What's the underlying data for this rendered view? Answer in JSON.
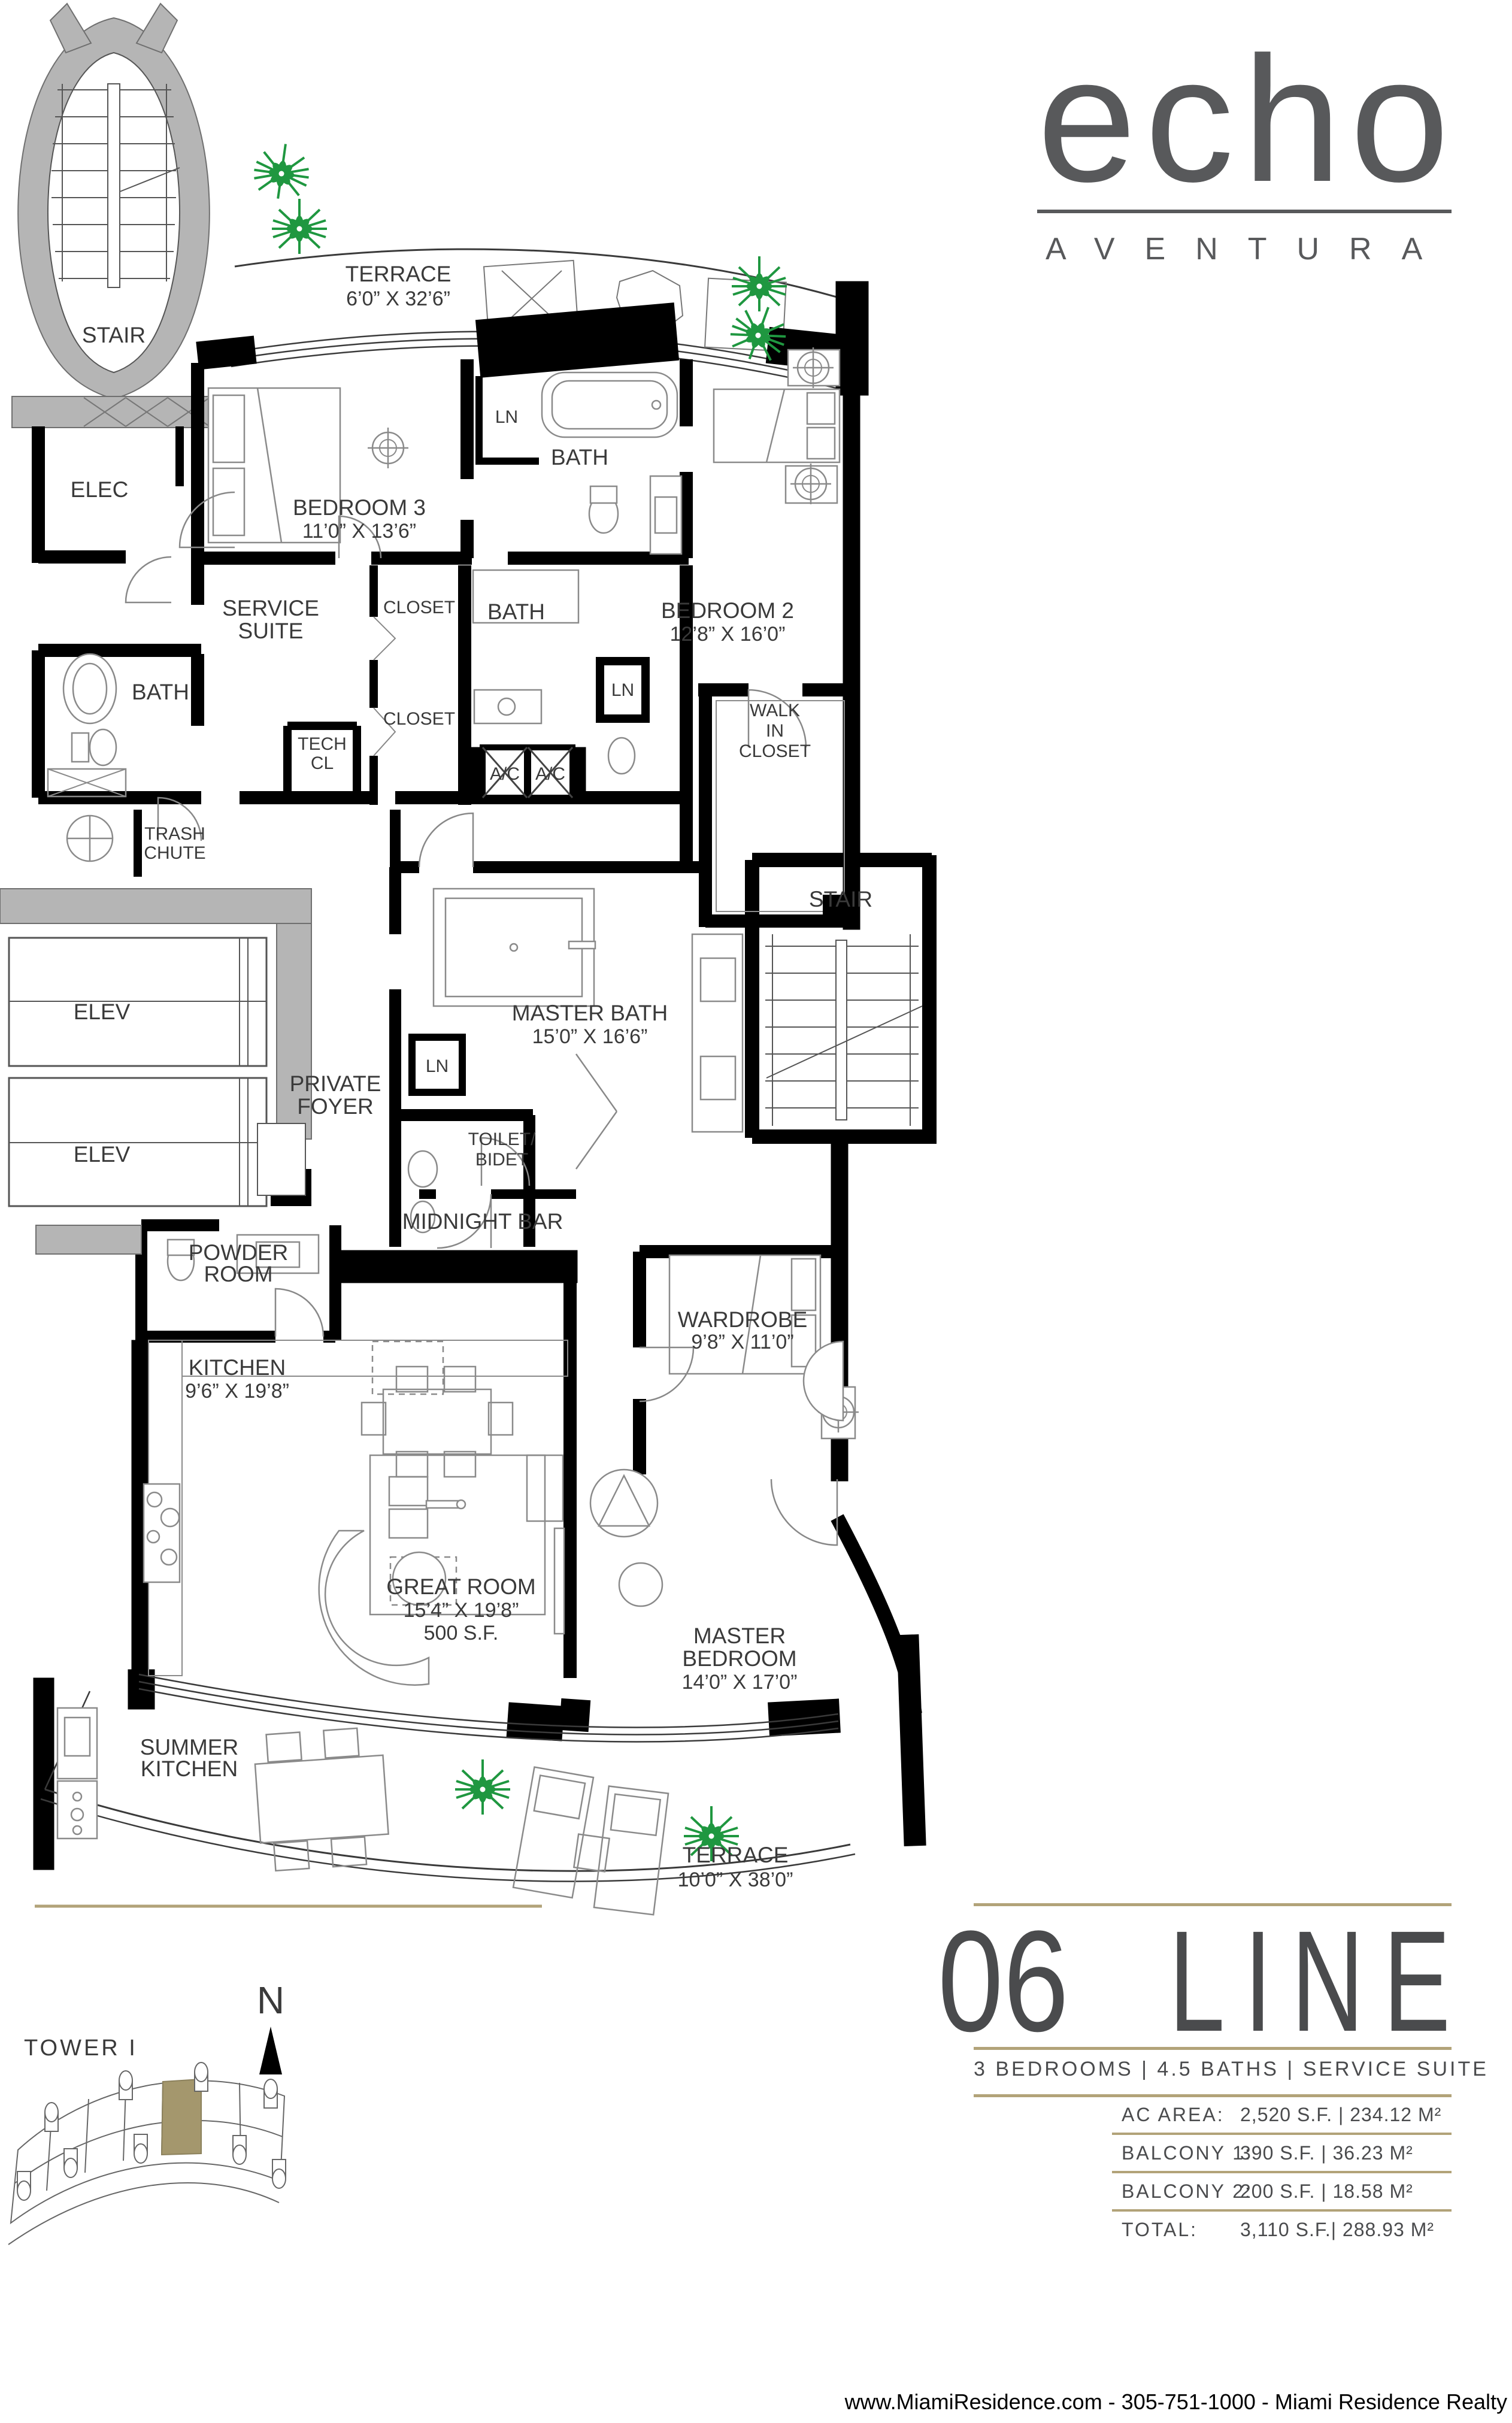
{
  "logo": {
    "brand": "echo",
    "subbrand": "AVENTURA"
  },
  "line_block": {
    "number": "06",
    "word": "LINE",
    "subtitle": "3 BEDROOMS | 4.5 BATHS | SERVICE SUITE",
    "specs": [
      {
        "label": "AC AREA:",
        "value": "2,520 S.F. | 234.12 M²"
      },
      {
        "label": "BALCONY 1:",
        "value": "390 S.F. | 36.23 M²"
      },
      {
        "label": "BALCONY 2:",
        "value": "200 S.F. | 18.58 M²"
      },
      {
        "label": "TOTAL:",
        "value": "3,110 S.F.| 288.93 M²"
      }
    ]
  },
  "key_plan": {
    "tower": "TOWER I",
    "north": "N"
  },
  "footer": "www.MiamiResidence.com  -  305-751-1000  -  Miami Residence Realty",
  "colors": {
    "accent_tan": "#b2a379",
    "highlight_unit": "#a4976d",
    "wall_black": "#000000",
    "shaft_gray": "#b5b5b5",
    "plant_green": "#1f9740",
    "text_dark": "#4a4b4d"
  },
  "rooms": {
    "terrace_top": {
      "name": "TERRACE",
      "dims": "6’0” X 32’6”"
    },
    "stair_nw": {
      "name": "STAIR"
    },
    "elec": {
      "name": "ELEC"
    },
    "bedroom3": {
      "name": "BEDROOM 3",
      "dims": "11’0” X 13’6”"
    },
    "ln_a": {
      "name": "LN"
    },
    "bath_a": {
      "name": "BATH"
    },
    "service_suite": {
      "l1": "SERVICE",
      "l2": "SUITE"
    },
    "closet_a": {
      "name": "CLOSET"
    },
    "bath_b": {
      "name": "BATH"
    },
    "bedroom2": {
      "name": "BEDROOM 2",
      "dims": "12’8” X 16’0”"
    },
    "bath_c": {
      "name": "BATH"
    },
    "ln_b": {
      "name": "LN"
    },
    "walk_in_closet": {
      "l1": "WALK",
      "l2": "IN",
      "l3": "CLOSET"
    },
    "tech_cl": {
      "l1": "TECH",
      "l2": "CL"
    },
    "closet_b": {
      "name": "CLOSET"
    },
    "ac_left": {
      "name": "A/C"
    },
    "ac_right": {
      "name": "A/C"
    },
    "trash_chute": {
      "l1": "TRASH",
      "l2": "CHUTE"
    },
    "stair_e": {
      "name": "STAIR"
    },
    "elev_1": {
      "name": "ELEV"
    },
    "elev_2": {
      "name": "ELEV"
    },
    "master_bath": {
      "name": "MASTER BATH",
      "dims": "15’0” X 16’6”"
    },
    "ln_c": {
      "name": "LN"
    },
    "private_foyer": {
      "l1": "PRIVATE",
      "l2": "FOYER"
    },
    "toilet_bidet": {
      "l1": "TOILET/",
      "l2": "BIDET"
    },
    "midnight_bar": {
      "name": "MIDNIGHT BAR"
    },
    "powder_room": {
      "l1": "POWDER",
      "l2": "ROOM"
    },
    "wardrobe": {
      "name": "WARDROBE",
      "dims": "9’8” X 11’0”"
    },
    "kitchen": {
      "name": "KITCHEN",
      "dims": "9’6” X 19’8”"
    },
    "great_room": {
      "name": "GREAT ROOM",
      "dims": "15’4” X 19’8”",
      "area": "500 S.F."
    },
    "master_bedroom": {
      "l1": "MASTER",
      "l2": "BEDROOM",
      "dims": "14’0” X 17’0”"
    },
    "summer_kitchen": {
      "l1": "SUMMER",
      "l2": "KITCHEN"
    },
    "terrace_bottom": {
      "name": "TERRACE",
      "dims": "10’0” X 38’0”"
    }
  }
}
